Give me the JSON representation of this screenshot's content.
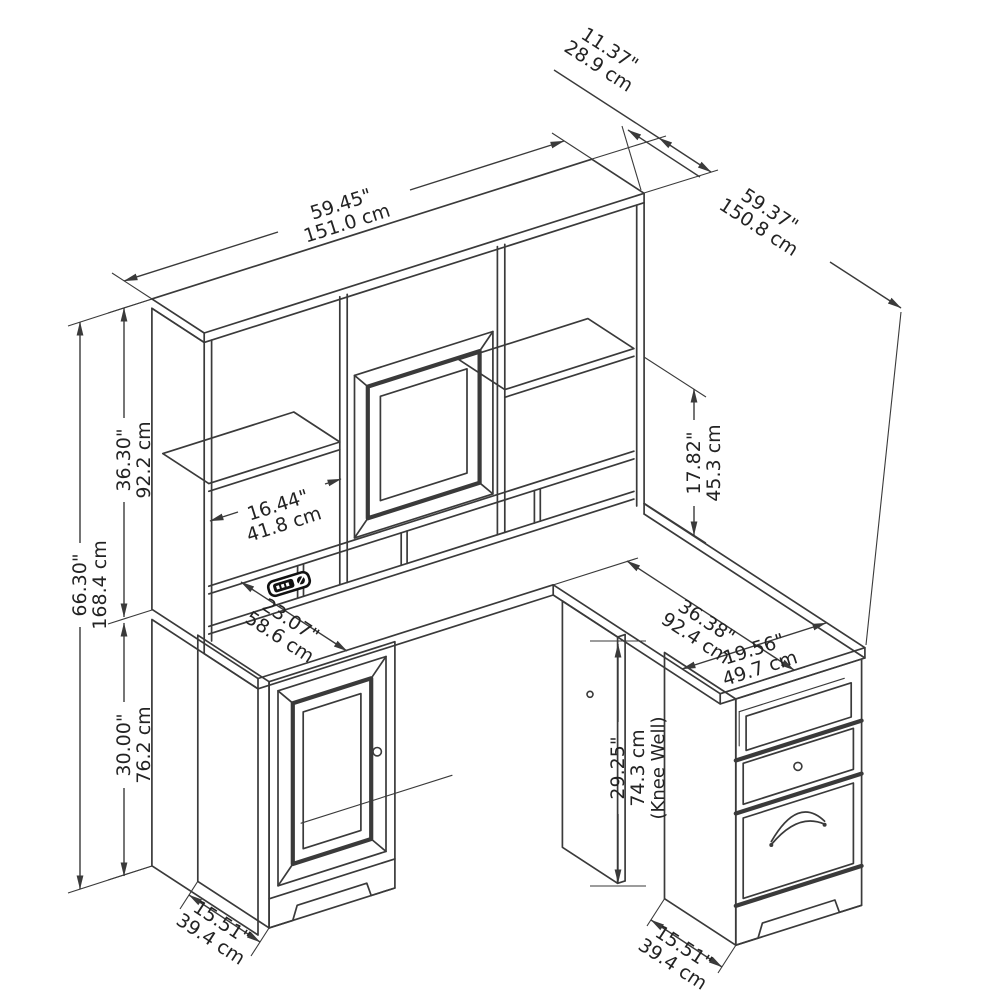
{
  "diagram": {
    "title": "l-shaped-desk-with-hutch-dimension-drawing",
    "line_color": "#3a3a3a",
    "background_color": "#ffffff",
    "dimensions": {
      "hutch_depth": {
        "inches": "11.37\"",
        "cm": "28.9 cm"
      },
      "hutch_width": {
        "inches": "59.45\"",
        "cm": "151.0 cm"
      },
      "return_length": {
        "inches": "59.37\"",
        "cm": "150.8 cm"
      },
      "overall_height": {
        "inches": "66.30\"",
        "cm": "168.4 cm"
      },
      "hutch_height": {
        "inches": "36.30\"",
        "cm": "92.2 cm"
      },
      "desk_height": {
        "inches": "30.00\"",
        "cm": "76.2 cm"
      },
      "hutch_opening_width": {
        "inches": "16.44\"",
        "cm": "41.8 cm"
      },
      "hutch_opening_height": {
        "inches": "17.82\"",
        "cm": "45.3 cm"
      },
      "desk_depth": {
        "inches": "23.07\"",
        "cm": "58.6 cm"
      },
      "return_surface_length": {
        "inches": "36.38\"",
        "cm": "92.4 cm"
      },
      "return_width": {
        "inches": "19.56\"",
        "cm": "49.7 cm"
      },
      "knee_well_height": {
        "inches": "29.25\"",
        "cm": "74.3 cm",
        "note": "(Knee Well)"
      },
      "cabinet_depth": {
        "inches": "15.51\"",
        "cm": "39.4 cm"
      },
      "pedestal_depth": {
        "inches": "15.51\"",
        "cm": "39.4 cm"
      }
    },
    "icons": [
      "power-grommet-icon",
      "door-knob-icon",
      "drawer-knob-icon",
      "drawer-handle-icon"
    ]
  }
}
